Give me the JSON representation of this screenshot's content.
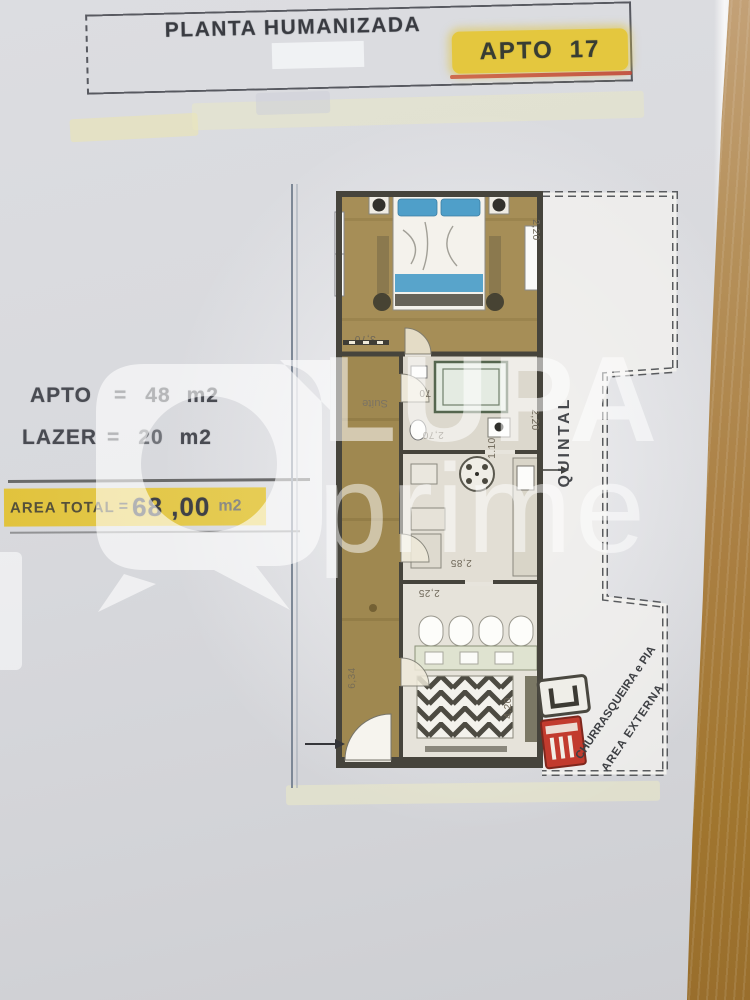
{
  "title_block": {
    "title": "PLANTA HUMANIZADA",
    "unit_label": "APTO",
    "unit_number": "17"
  },
  "info_panel": {
    "rows": [
      {
        "label": "APTO",
        "eq": "=",
        "value": "48",
        "unit": "m2"
      },
      {
        "label": "LAZER",
        "eq": "=",
        "value": "20",
        "unit": "m2"
      }
    ],
    "total": {
      "label": "AREA TOTAL",
      "eq": "=",
      "value": "68 ,00",
      "unit": "m2"
    }
  },
  "watermark": {
    "line1": "LUPA",
    "line2": "prime"
  },
  "floorplan": {
    "labels": {
      "suite": "Suíte",
      "quintal": "QUINTAL",
      "churrasqueira": "CHURRASQUEIRA e PIA",
      "area_externa": "AREA EXTERNA"
    },
    "dimensions": {
      "suite_width": "3,70",
      "suite_depth": "2,20",
      "door_width": "70",
      "bath_width": "2,70",
      "bath_inner": "1.10",
      "bath_depth": "2,20",
      "kitchen_width": "2,85",
      "kitchen_inner": "2,25",
      "living_depth": "4,20",
      "hall_length": "6,34"
    },
    "colors": {
      "wood_floor": "#a68e57",
      "bed_accent": "#4f9fc9",
      "wall": "#46443c",
      "grill_red": "#c23b2e",
      "highlight_yellow": "#e4c73e",
      "underline_red": "#bf4030"
    }
  }
}
